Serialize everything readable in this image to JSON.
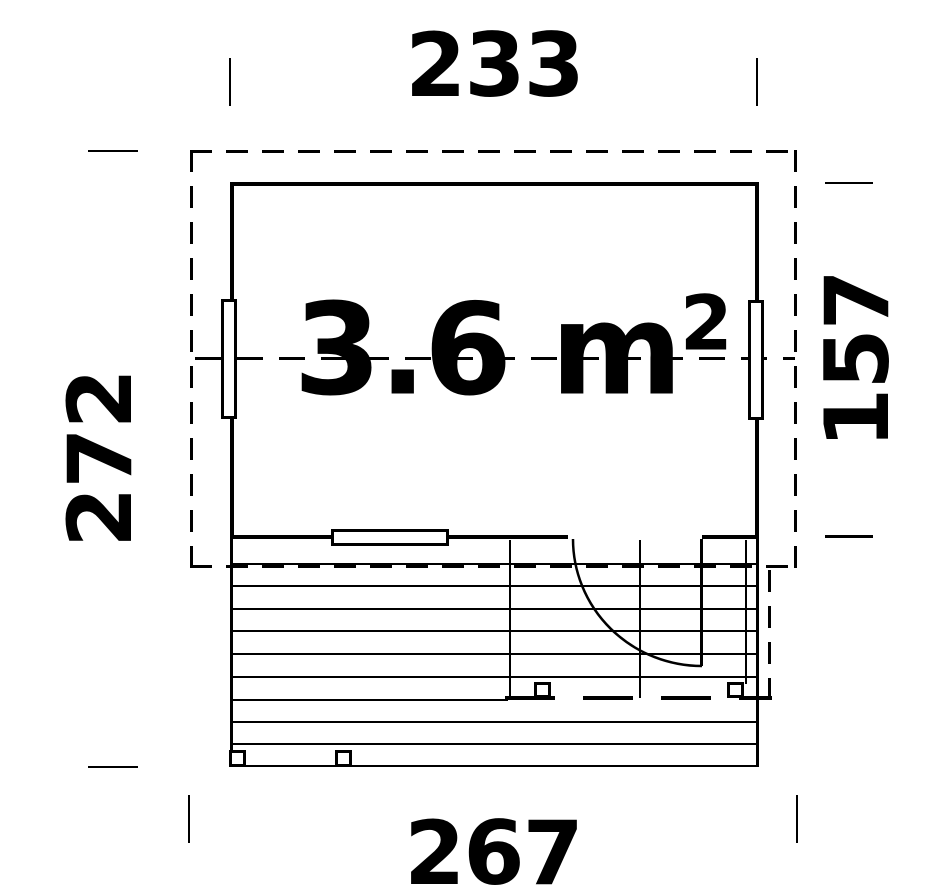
{
  "drawing": {
    "title": "floor-plan",
    "area_label": {
      "value": "3.6",
      "unit": " m",
      "exponent": "2"
    },
    "dimensions": {
      "top_width": "233",
      "right_depth": "157",
      "left_total_depth": "272",
      "bottom_total_width": "267"
    },
    "colors": {
      "line": "#000000",
      "background": "#ffffff"
    }
  }
}
